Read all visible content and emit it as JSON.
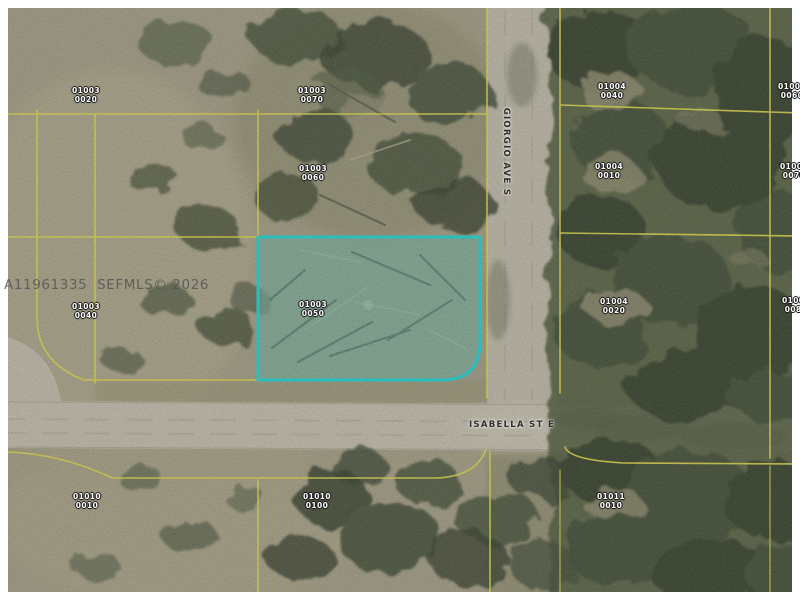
{
  "map_type": "aerial parcel map (MLS listing photo)",
  "watermark": "A11961335  SEFMLS© 2026",
  "streets": {
    "vertical": {
      "name": "GIORGIO AVE S"
    },
    "horizontal": {
      "name": "ISABELLA ST E"
    }
  },
  "selected_parcel": {
    "block": "01003",
    "lot": "0050",
    "highlight_color": "#0fe1e4"
  },
  "parcels": [
    {
      "block": "01003",
      "lot": "0020",
      "selected": false,
      "truncated": false
    },
    {
      "block": "01003",
      "lot": "0070",
      "selected": false,
      "truncated": false
    },
    {
      "block": "01004",
      "lot": "0040",
      "selected": false,
      "truncated": false
    },
    {
      "block": "01004",
      "lot": "0060",
      "selected": false,
      "truncated": true
    },
    {
      "block": "01003",
      "lot": "0060",
      "selected": false,
      "truncated": false
    },
    {
      "block": "01004",
      "lot": "0010",
      "selected": false,
      "truncated": false
    },
    {
      "block": "01004",
      "lot": "0070",
      "selected": false,
      "truncated": true
    },
    {
      "block": "01003",
      "lot": "0040",
      "selected": false,
      "truncated": false
    },
    {
      "block": "01003",
      "lot": "0050",
      "selected": true,
      "truncated": false
    },
    {
      "block": "01004",
      "lot": "0020",
      "selected": false,
      "truncated": false
    },
    {
      "block": "01004",
      "lot": "0080",
      "selected": false,
      "truncated": true
    },
    {
      "block": "01010",
      "lot": "0010",
      "selected": false,
      "truncated": false
    },
    {
      "block": "01010",
      "lot": "0100",
      "selected": false,
      "truncated": false
    },
    {
      "block": "01011",
      "lot": "0010",
      "selected": false,
      "truncated": false
    }
  ],
  "colors": {
    "parcel_line": "#ebe448",
    "highlight_outline": "#0fe1e4",
    "highlight_fill": "rgba(70,215,205,0.28)",
    "road": "#cbc5b6",
    "forest": "#39452e",
    "ground": "#a7a189",
    "frame": "#ffffff"
  }
}
